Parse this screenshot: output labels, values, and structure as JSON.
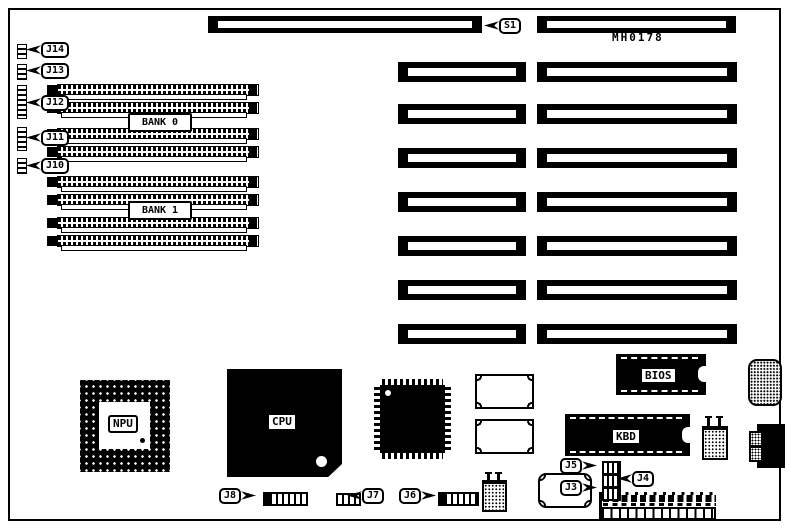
{
  "board": {
    "part_number": "MH0178"
  },
  "callouts": {
    "s1": "S1",
    "j3": "J3",
    "j4": "J4",
    "j5": "J5",
    "j6": "J6",
    "j7": "J7",
    "j8": "J8",
    "j10": "J10",
    "j11": "J11",
    "j12": "J12",
    "j13": "J13",
    "j14": "J14"
  },
  "banks": {
    "bank0": "BANK 0",
    "bank1": "BANK 1"
  },
  "chips": {
    "npu": "NPU",
    "cpu": "CPU",
    "bios": "BIOS",
    "kbd": "KBD"
  },
  "colors": {
    "ink": "#000000",
    "paper": "#ffffff"
  }
}
